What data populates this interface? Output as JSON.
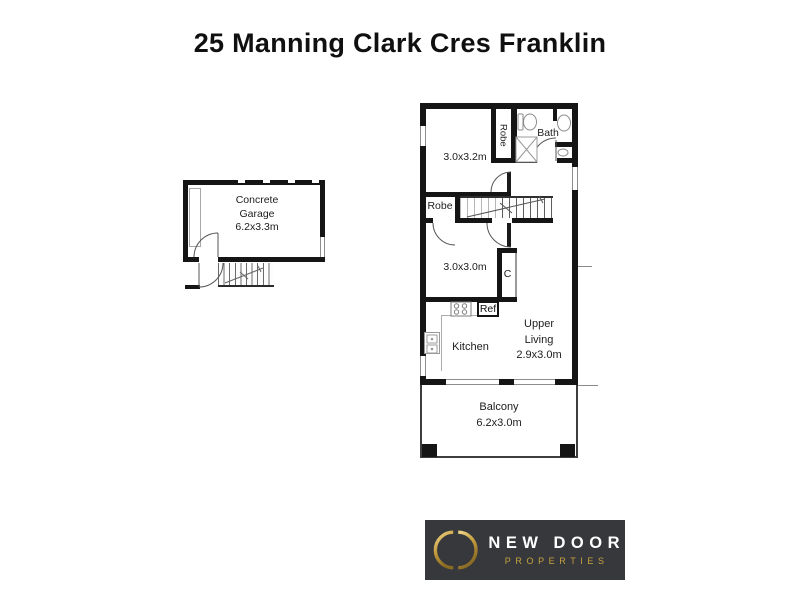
{
  "page": {
    "title": "25 Manning Clark Cres Franklin"
  },
  "garage_plan": {
    "garage": {
      "line1": "Concrete",
      "line2": "Garage",
      "line3": "6.2x3.3m"
    }
  },
  "upper_plan": {
    "bedroom1": {
      "size": "3.0x3.2m"
    },
    "robe1": {
      "label": "Robe"
    },
    "bath": {
      "label": "Bath"
    },
    "robe2": {
      "label": "Robe"
    },
    "bedroom2": {
      "size": "3.0x3.0m"
    },
    "cupboard": {
      "label": "C"
    },
    "fridge": {
      "label": "Ref"
    },
    "kitchen": {
      "label": "Kitchen"
    },
    "living": {
      "line1": "Upper",
      "line2": "Living",
      "line3": "2.9x3.0m"
    },
    "balcony": {
      "line1": "Balcony",
      "line2": "6.2x3.0m"
    }
  },
  "logo": {
    "brand": "NEW DOOR",
    "tagline": "PROPERTIES",
    "colors": {
      "background": "#36383b",
      "gold": "#c8a23f",
      "brand_text": "#ffffff"
    }
  }
}
